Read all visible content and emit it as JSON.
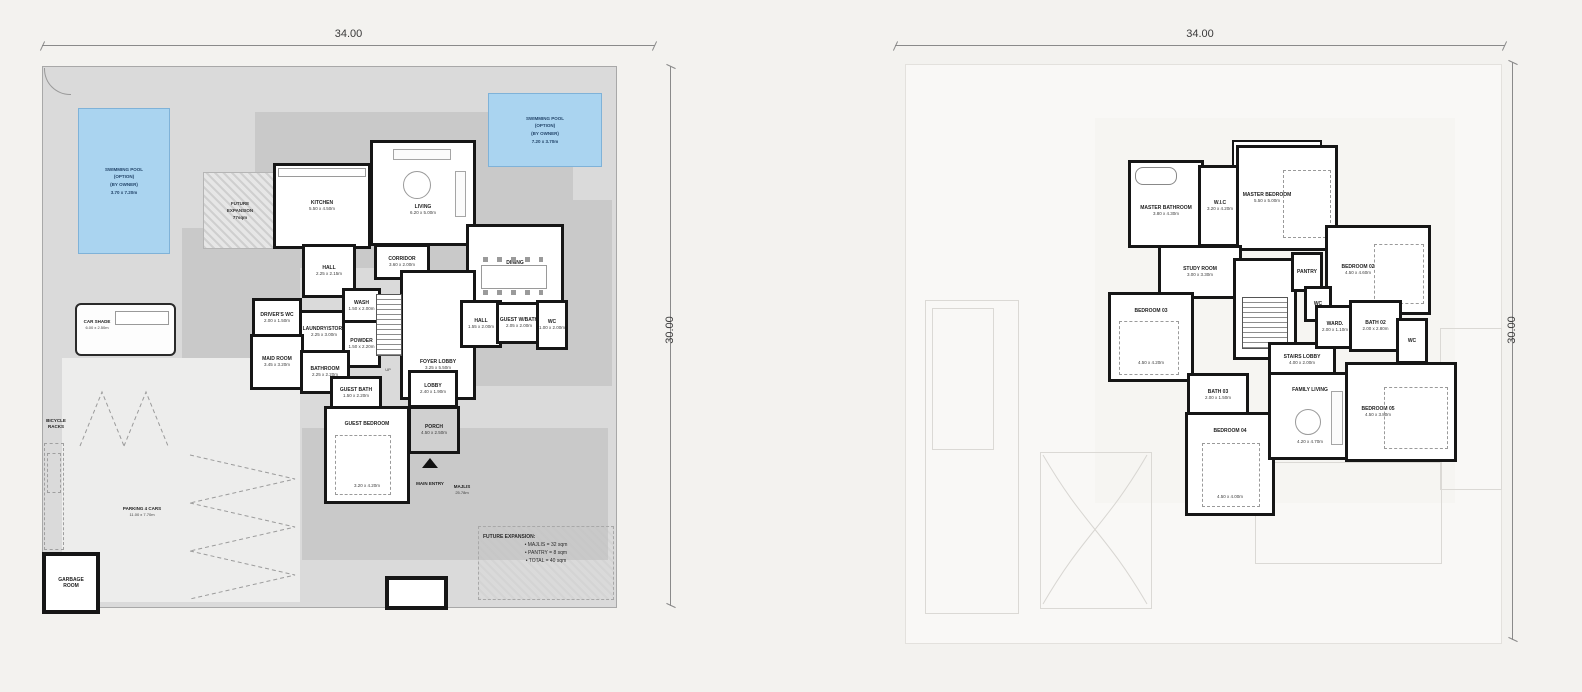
{
  "colors": {
    "pool_fill": "#aad4f0",
    "pool_border": "#7fb2d8",
    "plot_gray": "#dadada",
    "terrace_gray": "#c9c9c9",
    "wall_black": "#161616",
    "background": "#f3f2ef"
  },
  "left": {
    "dim_top": "34.00",
    "dim_right": "30.00",
    "pool_left": {
      "l1": "SWIMMING POOL",
      "l2": "(OPTION)",
      "l3": "(BY OWNER)",
      "l4": "3.70 x 7.20m"
    },
    "pool_right": {
      "l1": "SWIMMING POOL",
      "l2": "(OPTION)",
      "l3": "(BY OWNER)",
      "l4": "7.20 x 3.70m"
    },
    "future_patch": {
      "l1": "FUTURE",
      "l2": "EXPANSION",
      "l3": "77sqm"
    },
    "rooms": {
      "kitchen": {
        "name": "KITCHEN",
        "dims": "5.50 x 4.50m"
      },
      "living": {
        "name": "LIVING",
        "dims": "6.20 x 5.00m"
      },
      "dining": {
        "name": "DINING",
        "dims": "7.00 x 4.00m"
      },
      "hall_upper": {
        "name": "HALL",
        "dims": "2.25 x 2.15m"
      },
      "corridor": {
        "name": "CORRIDOR",
        "dims": "3.60 x 2.00m"
      },
      "laundry": {
        "name": "LAUNDRY/STORE",
        "dims": "2.25 x 3.00m"
      },
      "wash": {
        "name": "WASH",
        "dims": "1.50 x 2.00m"
      },
      "powder": {
        "name": "POWDER",
        "dims": "1.50 x 2.20m"
      },
      "drivers": {
        "name": "DRIVER'S WC",
        "dims": "2.00 x 1.50m"
      },
      "maid": {
        "name": "MAID ROOM",
        "dims": "3.45 x 3.20m"
      },
      "bathroom": {
        "name": "BATHROOM",
        "dims": "2.25 x 2.20m"
      },
      "foyer": {
        "name": "FOYER LOBBY",
        "dims": "3.25 x 5.50m"
      },
      "stairs_up": "UP",
      "hall2": {
        "name": "HALL",
        "dims": "1.55 x 2.00m"
      },
      "guest_wash": {
        "name": "GUEST W/BATH",
        "dims": "2.05 x 2.00m"
      },
      "wc": {
        "name": "WC",
        "dims": "1.00 x 2.00m"
      },
      "guest_bath": {
        "name": "GUEST BATH",
        "dims": "1.50 x 2.20m"
      },
      "guest_bed": {
        "name": "GUEST BEDROOM",
        "dims": "3.20 x 4.20m"
      },
      "lobby": {
        "name": "LOBBY",
        "dims": "2.40 x 1.90m"
      },
      "porch": {
        "name": "PORCH",
        "dims": "4.50 x 2.50m"
      }
    },
    "site": {
      "bicycle": {
        "l1": "BICYCLE",
        "l2": "RACKS"
      },
      "car_shade": {
        "name": "CAR SHADE",
        "dims": "6.00 x 2.50m"
      },
      "parking": {
        "name": "PARKING 4 CARS",
        "dims": "11.00 x 7.70m"
      },
      "garbage": {
        "l1": "GARBAGE",
        "l2": "ROOM"
      },
      "main_entry": "MAIN ENTRY",
      "majlis": {
        "name": "MAJLIS",
        "dims": "25.78m"
      },
      "future_note": {
        "title": "FUTURE EXPANSION:",
        "items": [
          "•  MAJLIS = 32 sqm",
          "•  PANTRY = 8 sqm",
          "•  TOTAL = 40 sqm"
        ]
      }
    }
  },
  "right": {
    "dim_top": "34.00",
    "dim_right": "30.00",
    "rooms": {
      "terrace": {
        "name": "TERRACE",
        "dims": "4.45 x 2.00m"
      },
      "master_bath": {
        "name": "MASTER BATHROOM",
        "dims": "3.80 x 4.30m"
      },
      "wic": {
        "name": "W.I.C",
        "dims": "3.20 x 4.20m"
      },
      "master_bed": {
        "name": "MASTER BEDROOM",
        "dims": "5.50 x 5.00m"
      },
      "bedroom02": {
        "name": "BEDROOM 02",
        "dims": "4.50 x 4.60m"
      },
      "study": {
        "name": "STUDY ROOM",
        "dims": "3.00 x 3.30m"
      },
      "staircase": {
        "name": "STAIR CASE",
        "dims": "3.60 x 4.20m"
      },
      "stairs_dn": "DN",
      "pantry": {
        "name": "PANTRY",
        "dims": "1.50 x 1.30m"
      },
      "wc_top": {
        "name": "WC",
        "dims": "1.20 x 2.00m"
      },
      "stairs_lobby": {
        "name": "STAIRS LOBBY",
        "dims": "4.00 x 2.00m"
      },
      "ward": {
        "name": "WARD.",
        "dims": "2.00 x 1.10m"
      },
      "bath02": {
        "name": "BATH 02",
        "dims": "2.00 x 2.80m"
      },
      "wc_right": {
        "name": "WC",
        "dims": "1.20 x 2.00m"
      },
      "bedroom03": {
        "name": "BEDROOM 03",
        "dims": "4.50 x 4.20m"
      },
      "bath03": {
        "name": "BATH 03",
        "dims": "2.00 x 1.50m"
      },
      "bedroom04": {
        "name": "BEDROOM 04",
        "dims": "4.50 x 4.00m"
      },
      "family": {
        "name": "FAMILY LIVING",
        "dims": "4.20 x 4.70m"
      },
      "bedroom05": {
        "name": "BEDROOM 05",
        "dims": "4.50 x 3.80m"
      }
    }
  }
}
